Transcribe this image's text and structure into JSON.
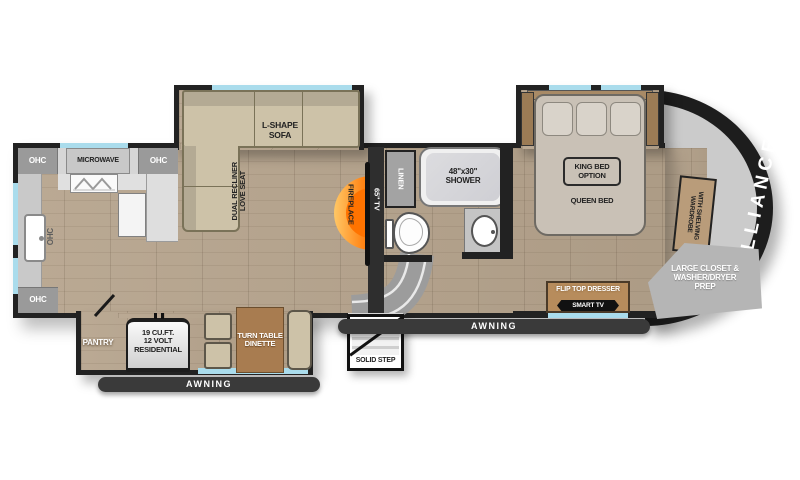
{
  "plan": {
    "brand": "ALLIANCE",
    "type": "fifth-wheel floorplan",
    "colors": {
      "slide_edge": "#aadcec",
      "floor_wood": "#b6a48d",
      "wall": "#222222",
      "cabinet_gray": "#9a9a9a",
      "counter_gray": "#d6d6d6",
      "sofa_tan": "#cdc2a8",
      "furniture_wood": "#a87c50",
      "fireplace_orange": "#ff7300",
      "awning_bar": "#3a3a3a"
    },
    "kitchen": {
      "ohc": "OHC",
      "microwave": "MICROWAVE"
    },
    "living": {
      "sofa_l1": "L-SHAPE",
      "sofa_l2": "SOFA",
      "loveseat_l1": "DUAL RECLINER",
      "loveseat_l2": "LOVE SEAT",
      "fireplace": "FIREPLACE",
      "tv": "65\" TV"
    },
    "bath": {
      "linen": "LINEN",
      "shower_l1": "48\"x30\"",
      "shower_l2": "SHOWER"
    },
    "bedroom": {
      "king_l1": "KING BED",
      "king_l2": "OPTION",
      "queen": "QUEEN BED",
      "dresser": "FLIP TOP DRESSER",
      "smart_tv": "SMART TV"
    },
    "front": {
      "wardrobe_l1": "WARDROBE",
      "wardrobe_l2": "WITH SHELVING",
      "closet_l1": "LARGE CLOSET &",
      "closet_l2": "WASHER/DRYER",
      "closet_l3": "PREP"
    },
    "galley": {
      "pantry": "PANTRY",
      "fridge_l1": "19 CU.FT.",
      "fridge_l2": "12 VOLT",
      "fridge_l3": "RESIDENTIAL",
      "dinette_l1": "TURN TABLE",
      "dinette_l2": "DINETTE"
    },
    "exterior": {
      "awning_left": "AWNING",
      "awning_right": "AWNING",
      "solid_step": "SOLID STEP"
    }
  }
}
